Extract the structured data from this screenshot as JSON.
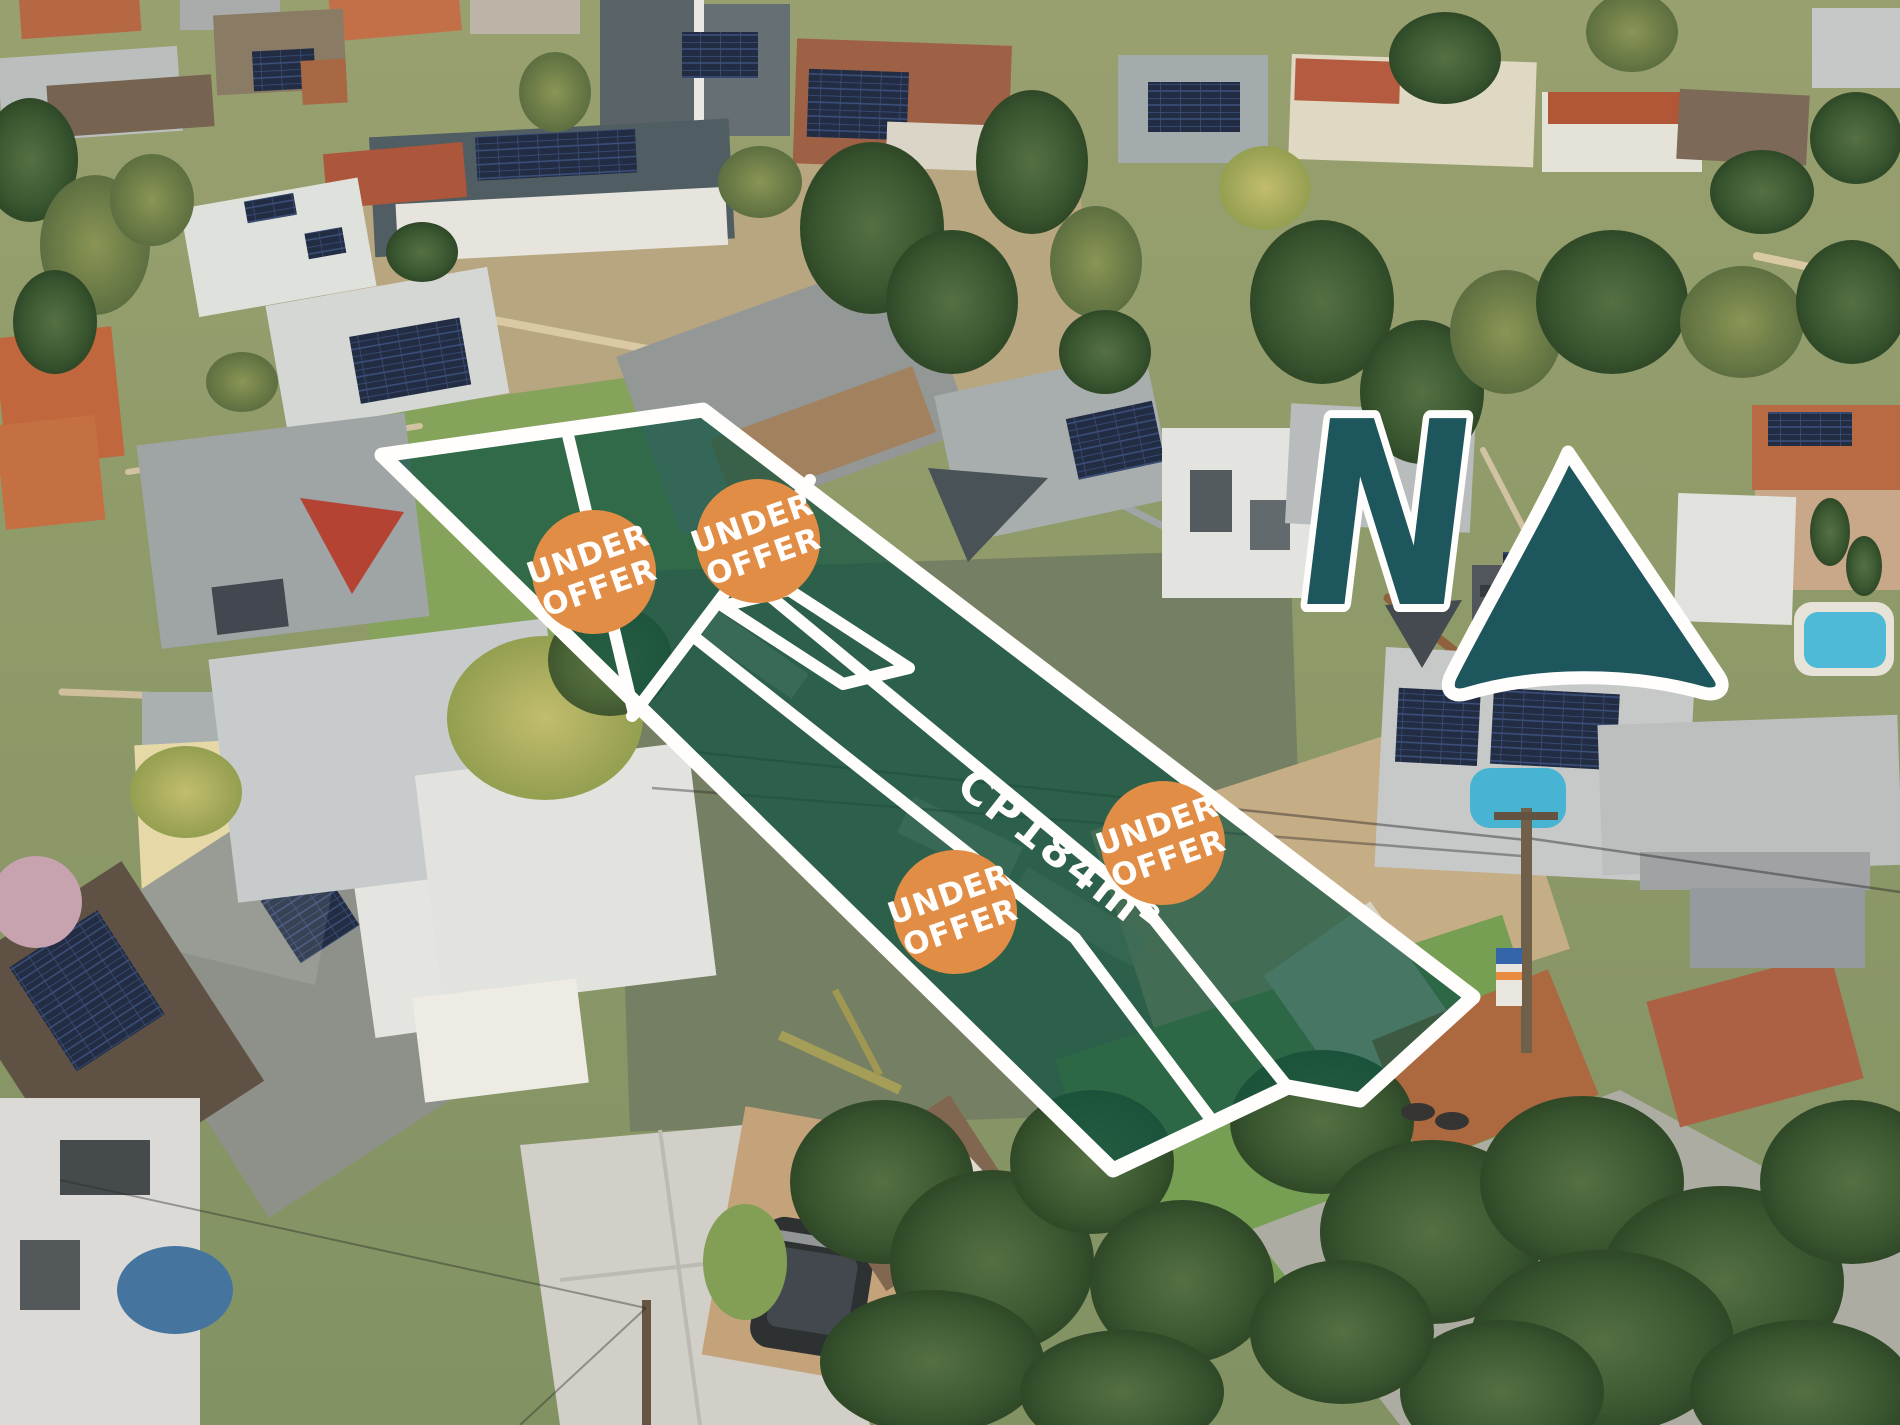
{
  "image_type": "aerial-real-estate-marketing-photo",
  "overlay": {
    "badges": [
      {
        "line1": "UNDER",
        "line2": "OFFER"
      },
      {
        "line1": "UNDER",
        "line2": "OFFER"
      },
      {
        "line1": "UNDER",
        "line2": "OFFER"
      },
      {
        "line1": "UNDER",
        "line2": "OFFER"
      }
    ],
    "cp_label": {
      "prefix": "CP",
      "area": "184m²"
    },
    "compass": {
      "letter": "N"
    }
  },
  "colors": {
    "lot_fill": "#0a4d3c",
    "lot_border": "#ffffff",
    "badge_orange": "#e0883f",
    "badge_text": "#ffffff",
    "compass_teal": "#114e57",
    "compass_outline": "#ffffff"
  }
}
